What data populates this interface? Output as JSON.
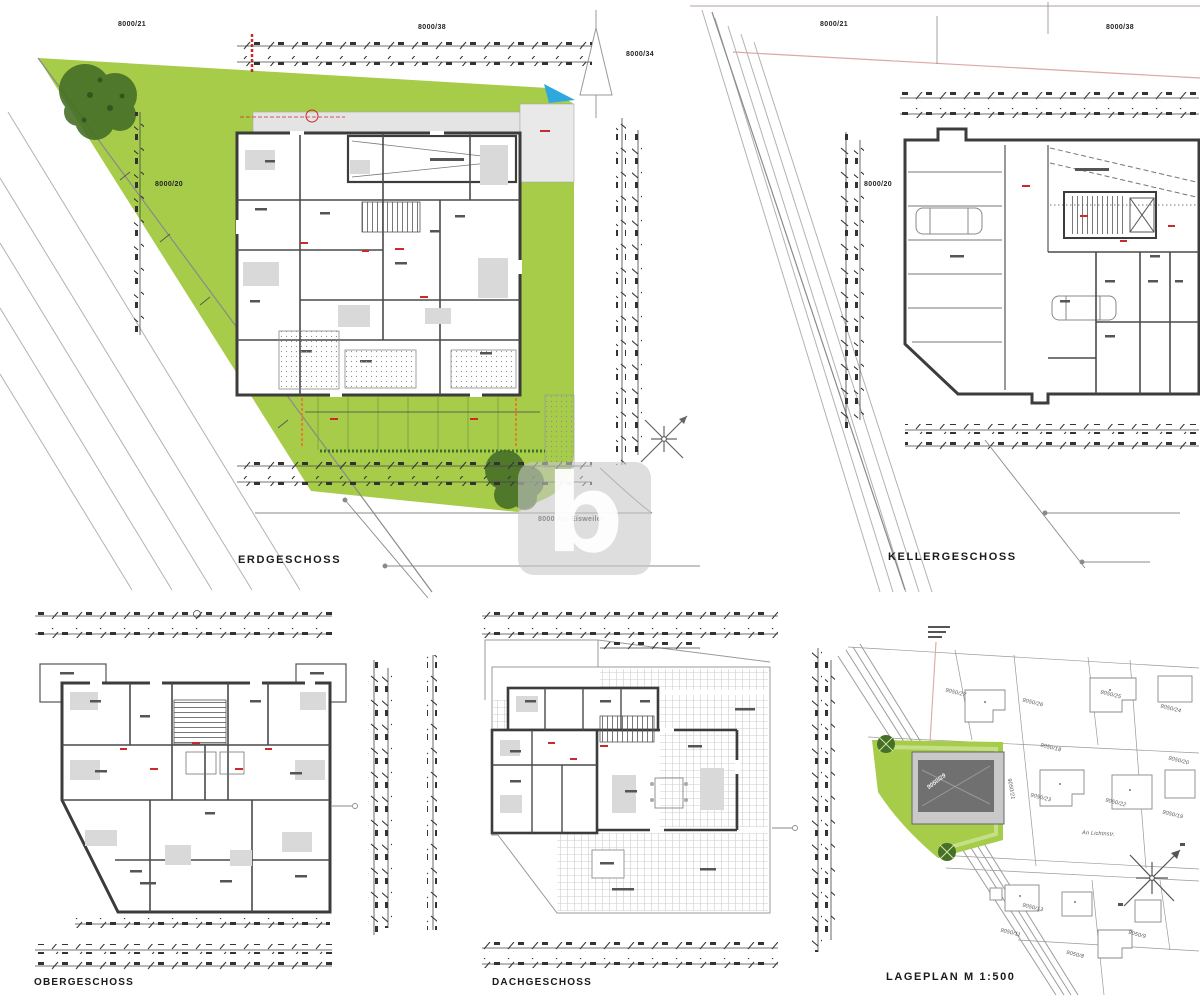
{
  "colors": {
    "grass": "#a6cc4a",
    "tree": "#466f27",
    "water": "#2fa8df",
    "wall": "#3c3c3c",
    "red": "#cc2a2a",
    "pink": "#dca7a7",
    "watermark": "#c8c8c8"
  },
  "watermark": {
    "letter": "b"
  },
  "plans": {
    "erdgeschoss": {
      "title": "ERDGESCHOSS",
      "parcel_top_left": "8000/21",
      "parcel_top_center": "8000/38",
      "parcel_top_right": "8000/34",
      "parcel_plot": "8000/20",
      "street_note": "8000 Am Eisweiler"
    },
    "kellergeschoss": {
      "title": "KELLERGESCHOSS",
      "parcel_top_left": "8000/21",
      "parcel_top_right": "8000/38",
      "parcel_plot": "8000/20"
    },
    "obergeschoss": {
      "title": "OBERGESCHOSS"
    },
    "dachgeschoss": {
      "title": "DACHGESCHOSS"
    },
    "lageplan": {
      "title": "LAGEPLAN  M 1:500",
      "street": "An Lichtnstr.",
      "subject_parcel": "9050/29",
      "parcels": [
        "9050/27",
        "9050/26",
        "9050/25",
        "9050/24",
        "9050/23",
        "9050/22",
        "9050/21",
        "9050/20",
        "9050/19",
        "9050/18",
        "9050/13",
        "9050/11",
        "9050/9",
        "9050/8"
      ]
    }
  }
}
